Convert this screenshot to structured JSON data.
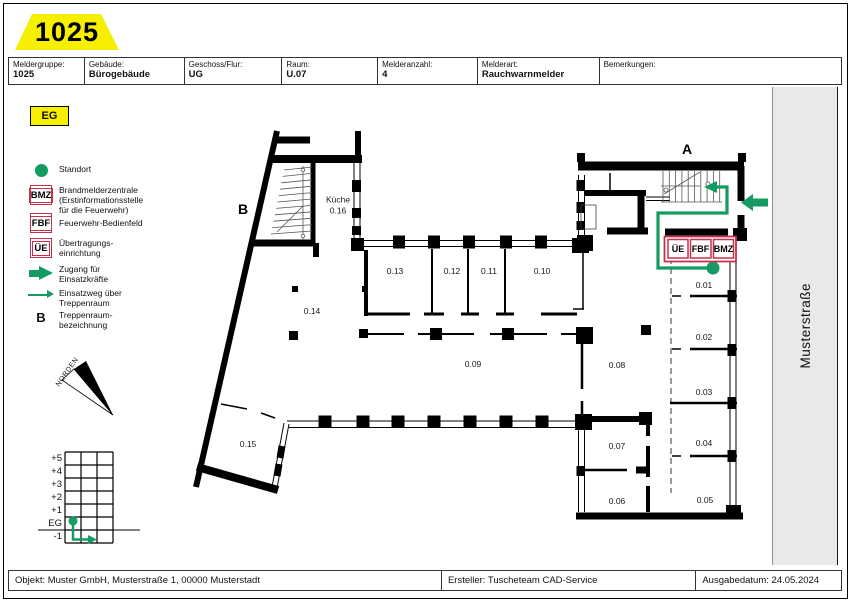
{
  "badge": {
    "number": "1025"
  },
  "floor_badge": {
    "label": "EG"
  },
  "header": {
    "cells": [
      {
        "label": "Meldergruppe:",
        "value": "1025"
      },
      {
        "label": "Gebäude:",
        "value": "Bürogebäude"
      },
      {
        "label": "Geschoss/Flur:",
        "value": "UG"
      },
      {
        "label": "Raum:",
        "value": "U.07"
      },
      {
        "label": "Melderanzahl:",
        "value": "4"
      },
      {
        "label": "Melderart:",
        "value": "Rauchwarnmelder"
      },
      {
        "label": "Bemerkungen:",
        "value": ""
      }
    ]
  },
  "legend": {
    "items": [
      {
        "symbol": "location-dot",
        "label": "Standort"
      },
      {
        "symbol": "bmz-box",
        "symbol_text": "BMZ",
        "label": "Brandmelderzentrale\n(Erstinformationsstelle\nfür die Feuerwehr)"
      },
      {
        "symbol": "fbf-box",
        "symbol_text": "FBF",
        "label": "Feuerwehr-Bedienfeld"
      },
      {
        "symbol": "ue-box",
        "symbol_text": "ÜE",
        "label": "Übertragungs-\neinrichtung"
      },
      {
        "symbol": "thick-arrow",
        "label": "Zugang für\nEinsatzkräfte"
      },
      {
        "symbol": "thin-arrow",
        "label": "Einsatzweg über\nTreppenraum"
      },
      {
        "symbol": "letter-b",
        "symbol_text": "B",
        "label": "Treppenraum-\nbezeichnung"
      }
    ]
  },
  "plan": {
    "stairwell_a": "A",
    "stairwell_b": "B",
    "kitchen_label": "Küche\n0.16",
    "room_labels": [
      "0.01",
      "0.02",
      "0.03",
      "0.04",
      "0.05",
      "0.06",
      "0.07",
      "0.08",
      "0.09",
      "0.10",
      "0.11",
      "0.12",
      "0.13",
      "0.14",
      "0.15"
    ],
    "panel_boxes": [
      "ÜE",
      "FBF",
      "BMZ"
    ]
  },
  "levels": {
    "labels": [
      "+5",
      "+4",
      "+3",
      "+2",
      "+1",
      "EG",
      "-1"
    ]
  },
  "compass": {
    "label": "NORDEN"
  },
  "street": {
    "name": "Musterstraße"
  },
  "footer": {
    "objekt": "Objekt: Muster GmbH, Musterstraße 1, 00000 Musterstadt",
    "ersteller": "Ersteller: Tuscheteam CAD-Service",
    "ausgabedatum": "Ausgabedatum: 24.05.2024"
  },
  "colors": {
    "badge_yellow": "#f7ef00",
    "escape_green": "#149b62",
    "alarm_red": "#c5304a",
    "street_gray": "#e9e9e9"
  }
}
